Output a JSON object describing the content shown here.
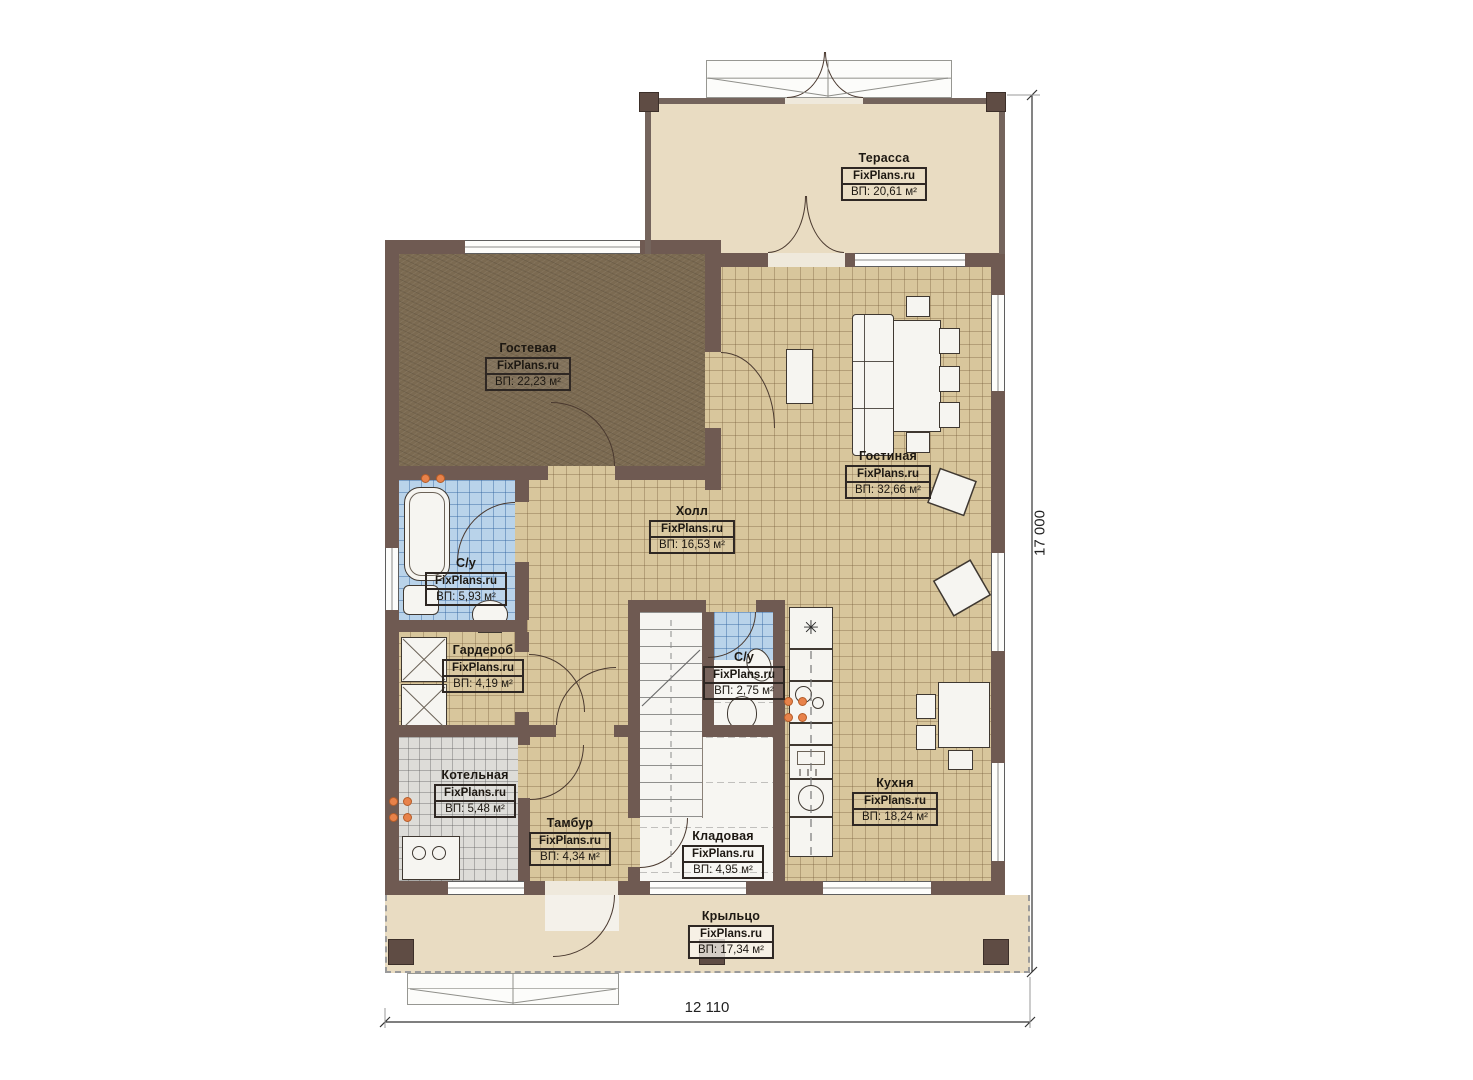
{
  "plan": {
    "watermark": "FixPlans.ru",
    "rooms": [
      {
        "key": "terrace",
        "name": "Терасса",
        "area": "ВП: 20,61 м²"
      },
      {
        "key": "guest",
        "name": "Гостевая",
        "area": "ВП: 22,23 м²"
      },
      {
        "key": "living",
        "name": "Гостиная",
        "area": "ВП: 32,66 м²"
      },
      {
        "key": "hall",
        "name": "Холл",
        "area": "ВП: 16,53 м²"
      },
      {
        "key": "bathroom",
        "name": "С/у",
        "area": "ВП: 5,93 м²"
      },
      {
        "key": "wardrobe",
        "name": "Гардероб",
        "area": "ВП: 4,19 м²"
      },
      {
        "key": "boiler",
        "name": "Котельная",
        "area": "ВП: 5,48 м²"
      },
      {
        "key": "vestibule",
        "name": "Тамбур",
        "area": "ВП: 4,34 м²"
      },
      {
        "key": "storage",
        "name": "Кладовая",
        "area": "ВП: 4,95 м²"
      },
      {
        "key": "wc",
        "name": "С/у",
        "area": "ВП: 2,75 м²"
      },
      {
        "key": "kitchen",
        "name": "Кухня",
        "area": "ВП: 18,24 м²"
      },
      {
        "key": "porch",
        "name": "Крыльцо",
        "area": "ВП: 17,34 м²"
      }
    ],
    "dimensions": {
      "bottom": "12 110",
      "right": "17 000"
    },
    "icons": {
      "freezer": "✳"
    },
    "colors": {
      "wall": "#6f5a52",
      "tile_floor": "#d8c69c",
      "guest_floor": "#7b6a51",
      "bath_tile": "#b9d3ea",
      "boiler_tile": "#dddcd8",
      "terrace_floor": "#e9dcc2",
      "fixture": "#f6f5f1",
      "radiator": "#e8824a"
    }
  }
}
